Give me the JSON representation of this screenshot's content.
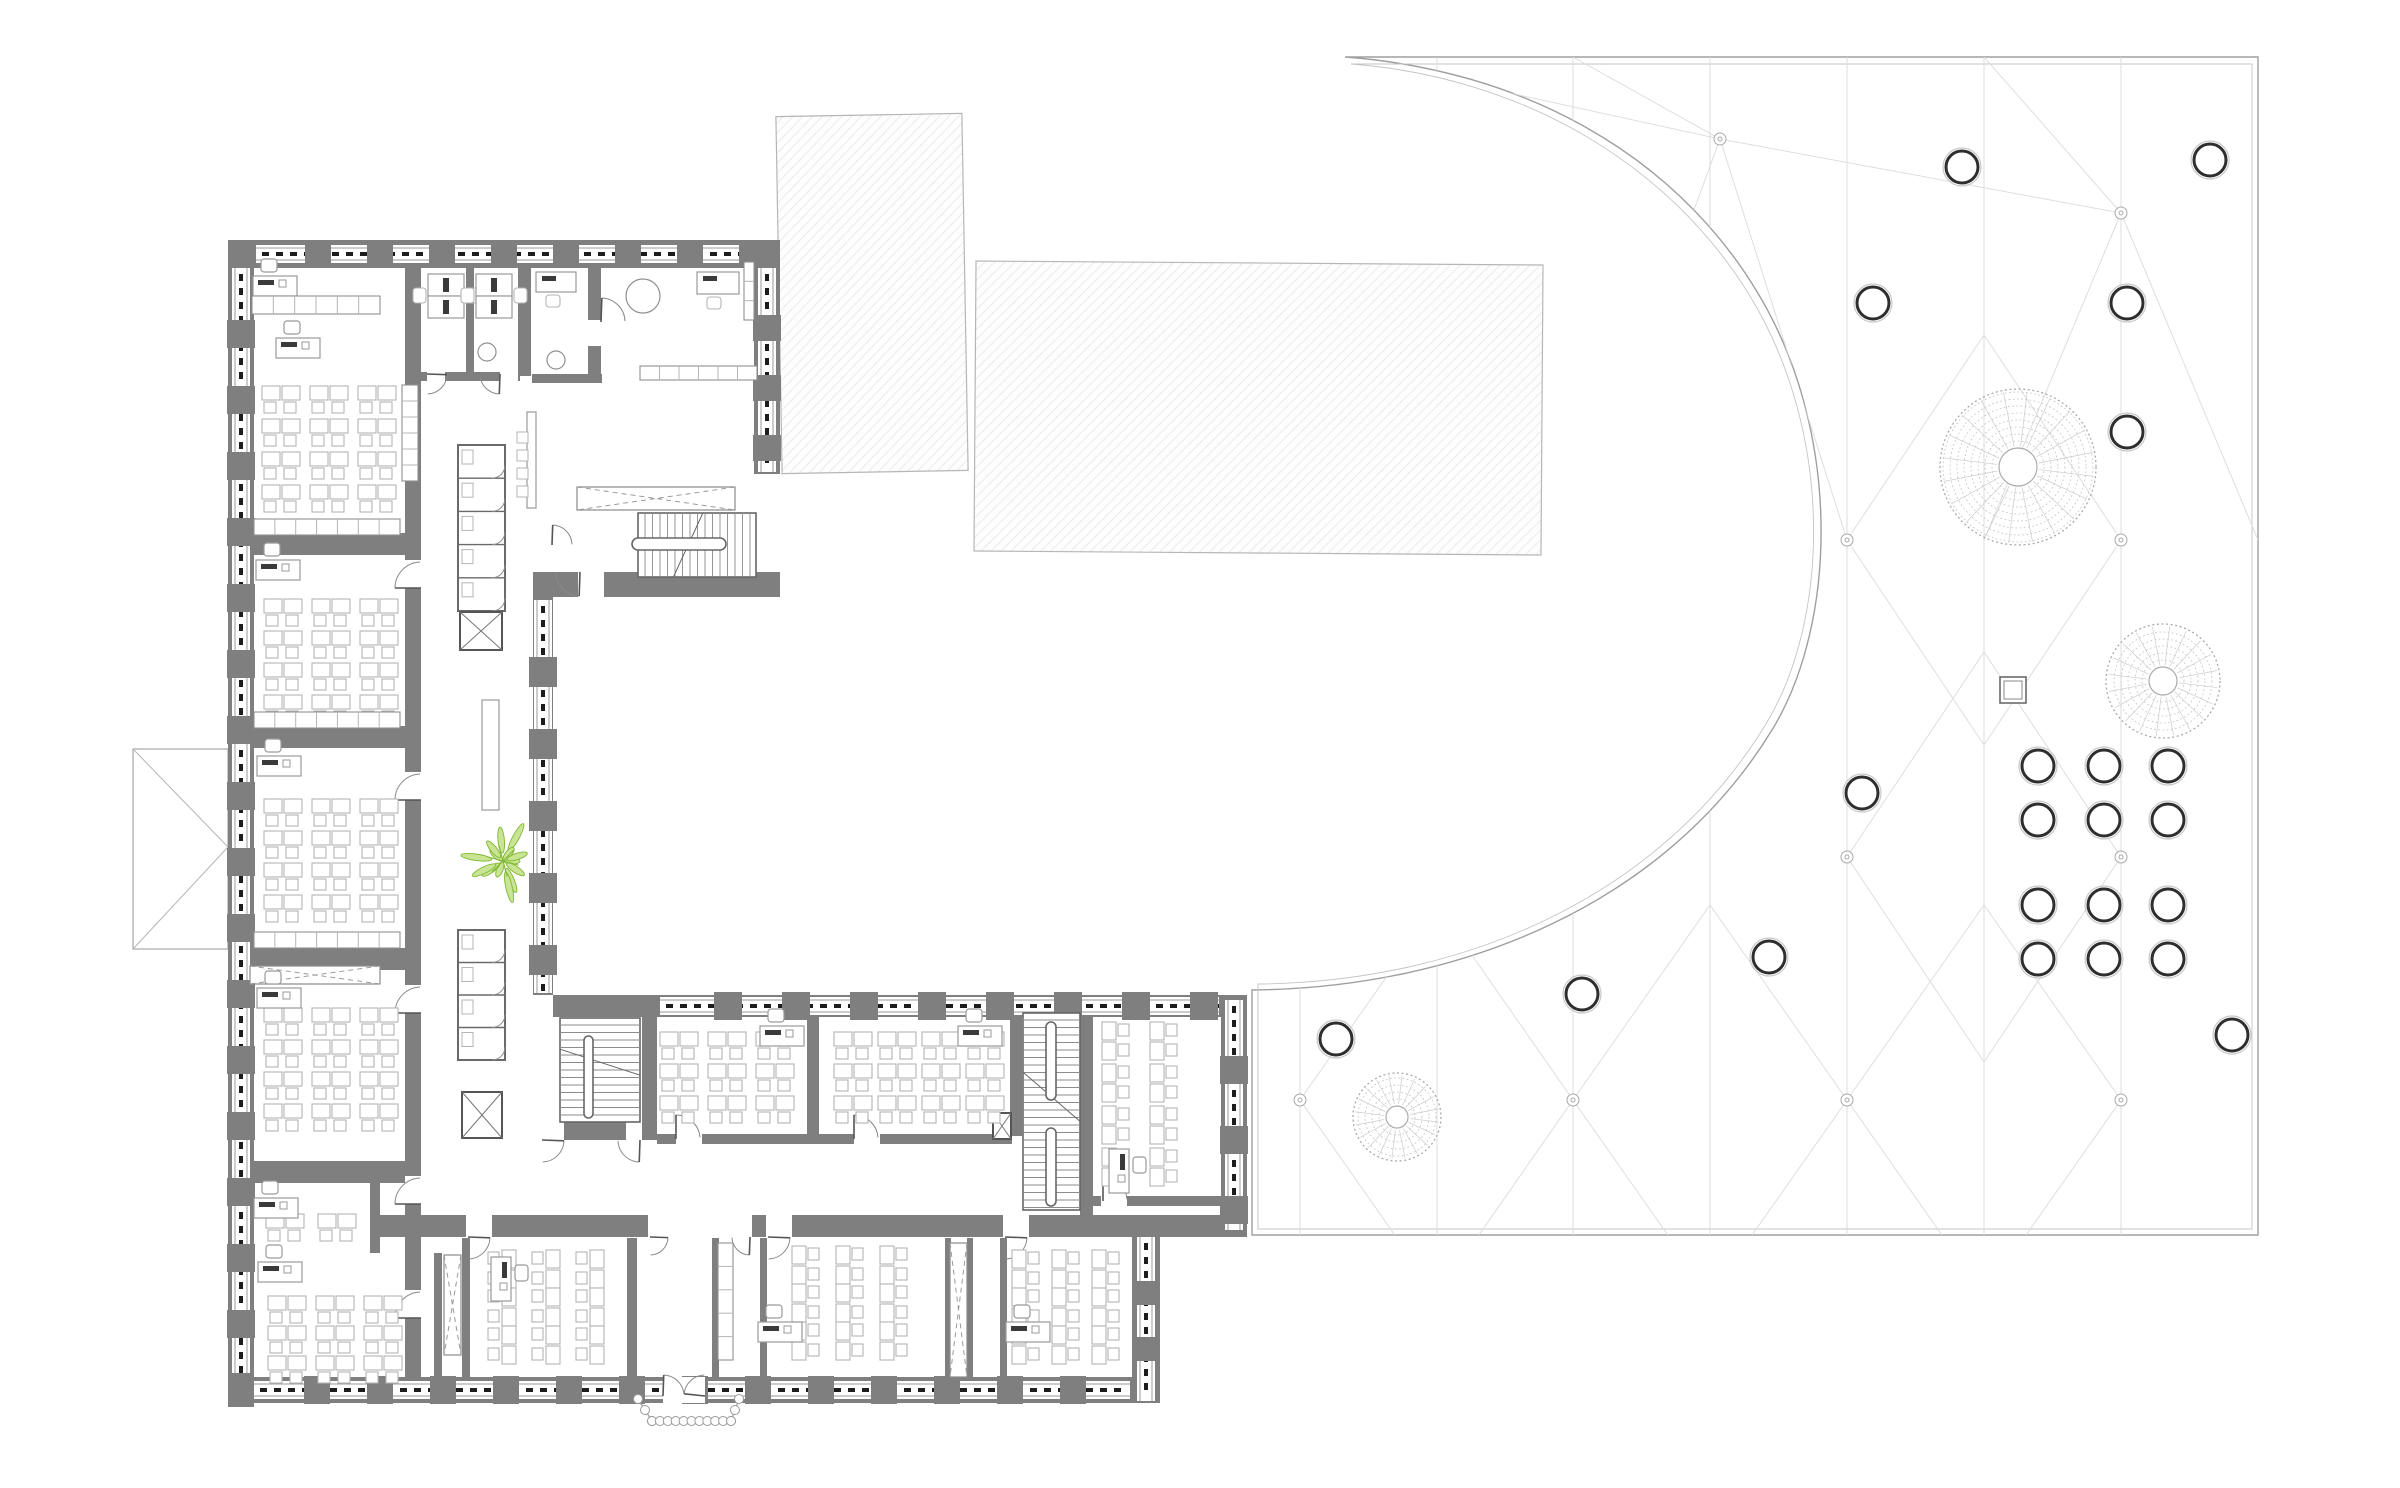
{
  "canvas": {
    "w": 2400,
    "h": 1488,
    "bg": "#ffffff"
  },
  "colors": {
    "wall": "#7f7f7f",
    "wall_edge": "#6a6a6a",
    "furniture": "#b4b4b4",
    "furniture_dark": "#8f8f8f",
    "monitor": "#3a3a3a",
    "window_line": "#9a9a9a",
    "window_dash": "#1c1c1c",
    "hatch_line": "#e2e2e2",
    "hatch_border": "#b6b6b6",
    "plaza_border": "#9f9f9f",
    "plaza_border2": "#c4c4c4",
    "mesh": "#dedede",
    "node": "#a8a8a8",
    "tree_ring": "#c3c3c3",
    "tree_rim": "#a9a9a9",
    "circle_dark": "#2e2e2e",
    "circle_halo": "#c9c9c9",
    "plant_fill": "#c9e492",
    "plant_stroke": "#7fb832",
    "door": "#8a8a8a",
    "thin": "#777777"
  },
  "hatched_rects": [
    [
      779,
      115,
      186,
      357,
      -1
    ],
    [
      975,
      263,
      567,
      290,
      0.4
    ]
  ],
  "gable": {
    "x": 133,
    "y": 749,
    "w": 95,
    "h": 200,
    "apex_x": 228,
    "apex_y": 847
  },
  "plaza": {
    "floor_path": "M 1345,57 L 2258,57 L 2258,1235 L 1252,1235 L 1252,990 C 1460,988 1665,905 1772,730 C 1838,622 1842,430 1756,290 C 1672,152 1520,70 1345,57 Z",
    "inner_path": "M 1351,64 L 2252,64 L 2252,1229 L 1258,1229 L 1258,984 C 1462,982 1660,898 1766,724 C 1830,618 1834,434 1750,296 C 1668,162 1520,77 1351,64 Z",
    "mesh_x": [
      1300,
      1437,
      1573,
      1710,
      1847,
      1984,
      2121
    ],
    "mesh_y_range": [
      57,
      1235
    ],
    "mesh_edges": [
      [
        1345,
        57,
        1720,
        139
      ],
      [
        1720,
        139,
        2121,
        213
      ],
      [
        1573,
        57,
        1720,
        139
      ],
      [
        1984,
        57,
        2121,
        213
      ],
      [
        1720,
        139,
        1847,
        540
      ],
      [
        1720,
        139,
        1573,
        540
      ],
      [
        2121,
        213,
        1984,
        540
      ],
      [
        2121,
        213,
        2258,
        540
      ],
      [
        1847,
        540,
        1984,
        335
      ],
      [
        1984,
        335,
        2121,
        540
      ],
      [
        1847,
        540,
        1984,
        745
      ],
      [
        1984,
        745,
        2121,
        540
      ],
      [
        1847,
        857,
        1984,
        652
      ],
      [
        1984,
        652,
        2121,
        857
      ],
      [
        1847,
        857,
        1984,
        1062
      ],
      [
        1984,
        1062,
        2121,
        857
      ],
      [
        1300,
        1100,
        1437,
        905
      ],
      [
        1437,
        905,
        1573,
        1100
      ],
      [
        1300,
        1100,
        1437,
        1295
      ],
      [
        1437,
        1295,
        1573,
        1100
      ],
      [
        1573,
        1100,
        1710,
        905
      ],
      [
        1710,
        905,
        1847,
        1100
      ],
      [
        1573,
        1100,
        1710,
        1295
      ],
      [
        1710,
        1295,
        1847,
        1100
      ],
      [
        1847,
        1100,
        1984,
        905
      ],
      [
        1984,
        905,
        2121,
        1100
      ],
      [
        1847,
        1100,
        1984,
        1295
      ],
      [
        1984,
        1295,
        2121,
        1100
      ]
    ],
    "nodes": [
      [
        1720,
        139
      ],
      [
        2121,
        213
      ],
      [
        1847,
        540
      ],
      [
        2121,
        540
      ],
      [
        1847,
        857
      ],
      [
        2121,
        857
      ],
      [
        1300,
        1100
      ],
      [
        1573,
        1100
      ],
      [
        1847,
        1100
      ],
      [
        2121,
        1100
      ]
    ],
    "trees": [
      [
        2018,
        467,
        78,
        19
      ],
      [
        2163,
        681,
        57,
        14
      ],
      [
        1397,
        1117,
        44,
        11
      ]
    ],
    "circles": [
      [
        1962,
        167
      ],
      [
        2210,
        160
      ],
      [
        1873,
        303
      ],
      [
        2127,
        303
      ],
      [
        2127,
        432
      ],
      [
        1862,
        793
      ],
      [
        1769,
        957
      ],
      [
        1582,
        994
      ],
      [
        1336,
        1039
      ],
      [
        2232,
        1035
      ],
      [
        2038,
        766
      ],
      [
        2104,
        766
      ],
      [
        2168,
        766
      ],
      [
        2038,
        820
      ],
      [
        2104,
        820
      ],
      [
        2168,
        820
      ],
      [
        2038,
        905
      ],
      [
        2104,
        905
      ],
      [
        2168,
        905
      ],
      [
        2038,
        959
      ],
      [
        2104,
        959
      ],
      [
        2168,
        959
      ]
    ],
    "circle_r": 16,
    "square": [
      2000,
      677,
      26
    ]
  },
  "walls": [
    [
      228,
      240,
      552,
      28
    ],
    [
      228,
      240,
      26,
      1167
    ],
    [
      754,
      268,
      26,
      206
    ],
    [
      533,
      572,
      247,
      25
    ],
    [
      228,
      533,
      193,
      22
    ],
    [
      228,
      726,
      193,
      22
    ],
    [
      228,
      948,
      193,
      22
    ],
    [
      228,
      1161,
      193,
      22
    ],
    [
      405,
      268,
      16,
      265
    ],
    [
      405,
      555,
      16,
      822
    ],
    [
      228,
      1377,
      932,
      26
    ],
    [
      1132,
      1233,
      28,
      170
    ],
    [
      370,
      1215,
      877,
      22
    ],
    [
      553,
      995,
      694,
      22
    ],
    [
      1221,
      995,
      26,
      240
    ],
    [
      533,
      596,
      20,
      399
    ],
    [
      642,
      1017,
      15,
      107
    ],
    [
      553,
      1122,
      104,
      18
    ],
    [
      807,
      1017,
      12,
      119
    ],
    [
      1010,
      1017,
      12,
      119
    ],
    [
      1080,
      1010,
      13,
      205
    ],
    [
      657,
      1134,
      355,
      10
    ],
    [
      1093,
      1196,
      130,
      10
    ],
    [
      462,
      1238,
      8,
      139
    ],
    [
      627,
      1238,
      10,
      139
    ],
    [
      712,
      1238,
      7,
      139
    ],
    [
      760,
      1238,
      7,
      139
    ],
    [
      945,
      1238,
      6,
      139
    ],
    [
      967,
      1238,
      6,
      139
    ],
    [
      1000,
      1238,
      7,
      139
    ],
    [
      434,
      1253,
      8,
      124
    ],
    [
      370,
      1183,
      10,
      70
    ],
    [
      466,
      268,
      8,
      108
    ],
    [
      518,
      268,
      13,
      108
    ],
    [
      588,
      268,
      13,
      112
    ],
    [
      420,
      372,
      100,
      9
    ],
    [
      532,
      374,
      70,
      9
    ]
  ],
  "wall_gaps": [
    [
      405,
      560,
      16,
      28
    ],
    [
      405,
      772,
      16,
      28
    ],
    [
      405,
      985,
      16,
      28
    ],
    [
      405,
      1176,
      16,
      28
    ],
    [
      405,
      1290,
      16,
      28
    ],
    [
      648,
      1215,
      104,
      22
    ],
    [
      663,
      1377,
      42,
      26
    ],
    [
      676,
      1134,
      26,
      10
    ],
    [
      854,
      1134,
      26,
      10
    ],
    [
      1101,
      1196,
      26,
      10
    ],
    [
      466,
      1215,
      26,
      22
    ],
    [
      766,
      1215,
      26,
      22
    ],
    [
      1003,
      1215,
      26,
      22
    ],
    [
      540,
      1122,
      24,
      18
    ],
    [
      626,
      1122,
      16,
      18
    ],
    [
      427,
      372,
      18,
      9
    ],
    [
      500,
      372,
      18,
      9
    ],
    [
      588,
      320,
      13,
      26
    ],
    [
      578,
      572,
      26,
      25
    ]
  ],
  "facades": [
    {
      "x": 256,
      "y": 254,
      "len": 498,
      "dir": "h",
      "step": 62,
      "plen": 26
    },
    {
      "x": 241,
      "y": 268,
      "len": 1105,
      "dir": "v",
      "step": 66,
      "plen": 28
    },
    {
      "x": 254,
      "y": 1390,
      "len": 876,
      "dir": "h",
      "step": 63,
      "plen": 26
    },
    {
      "x": 543,
      "y": 600,
      "len": 393,
      "dir": "v",
      "step": 72,
      "plen": 30
    },
    {
      "x": 660,
      "y": 1006,
      "len": 559,
      "dir": "h",
      "step": 68,
      "plen": 28
    },
    {
      "x": 1234,
      "y": 1000,
      "len": 230,
      "dir": "v",
      "step": 70,
      "plen": 28
    },
    {
      "x": 767,
      "y": 268,
      "len": 204,
      "dir": "v",
      "step": 60,
      "plen": 26
    },
    {
      "x": 1146,
      "y": 1237,
      "len": 164,
      "dir": "v",
      "step": 56,
      "plen": 24
    }
  ],
  "desk_grids": [
    [
      262,
      386,
      3,
      4,
      48,
      33,
      "down"
    ],
    [
      264,
      599,
      3,
      4,
      48,
      32,
      "down"
    ],
    [
      264,
      799,
      3,
      4,
      48,
      32,
      "down"
    ],
    [
      264,
      1008,
      3,
      4,
      48,
      32,
      "down"
    ],
    [
      266,
      1214,
      2,
      1,
      52,
      32,
      "down"
    ],
    [
      268,
      1296,
      3,
      3,
      48,
      30,
      "down"
    ],
    [
      660,
      1032,
      3,
      3,
      48,
      32,
      "down"
    ],
    [
      834,
      1032,
      4,
      3,
      44,
      32,
      "down"
    ],
    [
      1102,
      1022,
      2,
      4,
      48,
      42,
      "right"
    ],
    [
      502,
      1250,
      3,
      3,
      44,
      38,
      "left"
    ],
    [
      792,
      1246,
      3,
      3,
      44,
      38,
      "right"
    ],
    [
      1012,
      1250,
      3,
      3,
      40,
      38,
      "right"
    ]
  ],
  "teacher_desks": [
    [
      253,
      276,
      0
    ],
    [
      276,
      338,
      0
    ],
    [
      256,
      560,
      0
    ],
    [
      257,
      756,
      0
    ],
    [
      257,
      988,
      0
    ],
    [
      254,
      1198,
      0
    ],
    [
      258,
      1262,
      0
    ],
    [
      760,
      1026,
      0
    ],
    [
      958,
      1026,
      0
    ],
    [
      1098,
      1160,
      90
    ],
    [
      480,
      1268,
      90
    ],
    [
      758,
      1322,
      0
    ],
    [
      1006,
      1322,
      0
    ]
  ],
  "office_pairs": [
    [
      428,
      274
    ],
    [
      476,
      274
    ]
  ],
  "small_desks": [
    [
      536,
      272,
      40,
      20
    ],
    [
      697,
      272,
      42,
      22
    ]
  ],
  "round_tables": [
    [
      643,
      296,
      17
    ],
    [
      487,
      352,
      9
    ],
    [
      556,
      360,
      9
    ]
  ],
  "shelf_rows": [
    [
      254,
      519,
      146,
      16,
      7,
      "h"
    ],
    [
      254,
      712,
      146,
      16,
      7,
      "h"
    ],
    [
      254,
      932,
      146,
      16,
      7,
      "h"
    ],
    [
      640,
      366,
      117,
      14,
      6,
      "h"
    ],
    [
      718,
      1243,
      15,
      117,
      5,
      "v"
    ],
    [
      252,
      296,
      128,
      18,
      6,
      "h"
    ],
    [
      402,
      385,
      16,
      96,
      6,
      "v"
    ],
    [
      744,
      262,
      10,
      58,
      3,
      "v"
    ]
  ],
  "benches": [
    [
      482,
      700,
      17,
      110
    ],
    [
      527,
      412,
      9,
      96
    ]
  ],
  "stools": [
    [
      517,
      432
    ],
    [
      517,
      450
    ],
    [
      517,
      468
    ],
    [
      517,
      486
    ]
  ],
  "stairs": [
    {
      "x": 638,
      "y": 513,
      "w": 118,
      "h": 64,
      "dir": "h",
      "caps": [
        [
          632,
          538,
          94,
          12
        ]
      ]
    },
    {
      "x": 1023,
      "y": 1013,
      "w": 57,
      "h": 197,
      "dir": "v",
      "caps": [
        [
          1046,
          1022,
          10,
          78
        ],
        [
          1046,
          1128,
          10,
          78
        ]
      ]
    },
    {
      "x": 560,
      "y": 1018,
      "w": 80,
      "h": 104,
      "dir": "v",
      "caps": [
        [
          584,
          1036,
          9,
          82
        ]
      ]
    }
  ],
  "wc_cores": [
    {
      "x": 458,
      "y": 445,
      "w": 47,
      "h": 166,
      "stalls": 5
    },
    {
      "x": 458,
      "y": 930,
      "w": 47,
      "h": 130,
      "stalls": 4
    }
  ],
  "x_boxes": [
    [
      460,
      612,
      42,
      38
    ],
    [
      462,
      1092,
      40,
      46
    ],
    [
      993,
      1113,
      18,
      26
    ]
  ],
  "dash_x_strips": [
    [
      577,
      487,
      158,
      23
    ],
    [
      444,
      1255,
      17,
      100
    ],
    [
      950,
      1243,
      17,
      134
    ],
    [
      250,
      966,
      130,
      18
    ]
  ],
  "door_arcs": [
    [
      421,
      588,
      26,
      180,
      268
    ],
    [
      421,
      800,
      26,
      180,
      268
    ],
    [
      421,
      1013,
      26,
      180,
      268
    ],
    [
      421,
      1204,
      26,
      180,
      268
    ],
    [
      421,
      1318,
      26,
      180,
      268
    ],
    [
      676,
      1139,
      24,
      270,
      356
    ],
    [
      854,
      1139,
      24,
      270,
      356
    ],
    [
      1103,
      1201,
      24,
      270,
      356
    ],
    [
      468,
      1237,
      22,
      2,
      88
    ],
    [
      768,
      1237,
      22,
      2,
      88
    ],
    [
      1005,
      1237,
      22,
      2,
      88
    ],
    [
      650,
      1237,
      18,
      2,
      88
    ],
    [
      750,
      1237,
      18,
      92,
      178
    ],
    [
      663,
      1396,
      21,
      272,
      354
    ],
    [
      705,
      1396,
      21,
      186,
      268
    ],
    [
      427,
      374,
      20,
      2,
      88
    ],
    [
      500,
      374,
      20,
      92,
      178
    ],
    [
      601,
      322,
      24,
      272,
      358
    ],
    [
      580,
      572,
      24,
      92,
      178
    ],
    [
      552,
      545,
      20,
      272,
      358
    ],
    [
      542,
      1140,
      22,
      2,
      88
    ],
    [
      640,
      1140,
      22,
      92,
      178
    ]
  ],
  "entrance": {
    "trapezoid": [
      [
        638,
        1399
      ],
      [
        652,
        1421
      ],
      [
        731,
        1421
      ],
      [
        739,
        1399
      ]
    ],
    "circle_r": 4.5
  },
  "plant": {
    "x": 503,
    "y": 861
  }
}
